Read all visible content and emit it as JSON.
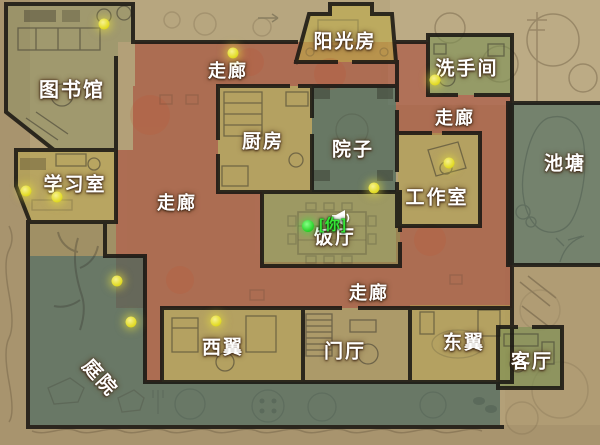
{
  "colors": {
    "parchment": "#b3a078",
    "corridor_red": "#a84938",
    "room_olive": "#b5a24e",
    "sunroom_yellow": "#c0ae4a",
    "library_olive": "#8e9163",
    "green_room": "#7c9154",
    "dining_green": "#8d9555",
    "foyer_tan": "#a6935a",
    "garden_teal": "#46655e",
    "pond_teal": "#4d6f68",
    "yard_teal": "#42625a",
    "wall_black": "#1a1713",
    "marker_yellow": "#e9e33c",
    "player_green": "#35d435",
    "label_white": "#ffffff"
  },
  "rooms": [
    {
      "id": "library",
      "label": "图书馆",
      "x": 72,
      "y": 88,
      "size": 20
    },
    {
      "id": "study",
      "label": "学习室",
      "x": 75,
      "y": 183,
      "size": 19
    },
    {
      "id": "corridor-top",
      "label": "走廊",
      "x": 228,
      "y": 70,
      "size": 18
    },
    {
      "id": "sunroom",
      "label": "阳光房",
      "x": 345,
      "y": 40,
      "size": 19
    },
    {
      "id": "washroom",
      "label": "洗手间",
      "x": 467,
      "y": 67,
      "size": 19
    },
    {
      "id": "corridor-right",
      "label": "走廊",
      "x": 455,
      "y": 117,
      "size": 18
    },
    {
      "id": "kitchen",
      "label": "厨房",
      "x": 263,
      "y": 140,
      "size": 19
    },
    {
      "id": "yard",
      "label": "院子",
      "x": 353,
      "y": 148,
      "size": 19
    },
    {
      "id": "pond",
      "label": "池塘",
      "x": 565,
      "y": 162,
      "size": 19
    },
    {
      "id": "workshop",
      "label": "工作室",
      "x": 437,
      "y": 196,
      "size": 19
    },
    {
      "id": "corridor-left",
      "label": "走廊",
      "x": 177,
      "y": 202,
      "size": 18
    },
    {
      "id": "dining",
      "label": "饭厅",
      "x": 335,
      "y": 236,
      "size": 19
    },
    {
      "id": "corridor-bottom",
      "label": "走廊",
      "x": 369,
      "y": 292,
      "size": 18
    },
    {
      "id": "garden",
      "label": "庭院",
      "x": 101,
      "y": 377,
      "size": 19,
      "rotate": true
    },
    {
      "id": "west-wing",
      "label": "西翼",
      "x": 223,
      "y": 346,
      "size": 19
    },
    {
      "id": "foyer",
      "label": "门厅",
      "x": 345,
      "y": 350,
      "size": 19
    },
    {
      "id": "east-wing",
      "label": "东翼",
      "x": 464,
      "y": 341,
      "size": 19
    },
    {
      "id": "living",
      "label": "客厅",
      "x": 532,
      "y": 360,
      "size": 19
    }
  ],
  "player": {
    "label": "[你]",
    "tag_x": 333,
    "tag_y": 224,
    "dot_x": 308,
    "dot_y": 226
  },
  "speaker": {
    "x": 330,
    "y": 209
  },
  "markers": {
    "points": [
      [
        104,
        24
      ],
      [
        233,
        53
      ],
      [
        435,
        80
      ],
      [
        26,
        191
      ],
      [
        57,
        197
      ],
      [
        449,
        163
      ],
      [
        374,
        188
      ],
      [
        117,
        281
      ],
      [
        131,
        322
      ],
      [
        216,
        321
      ]
    ]
  }
}
